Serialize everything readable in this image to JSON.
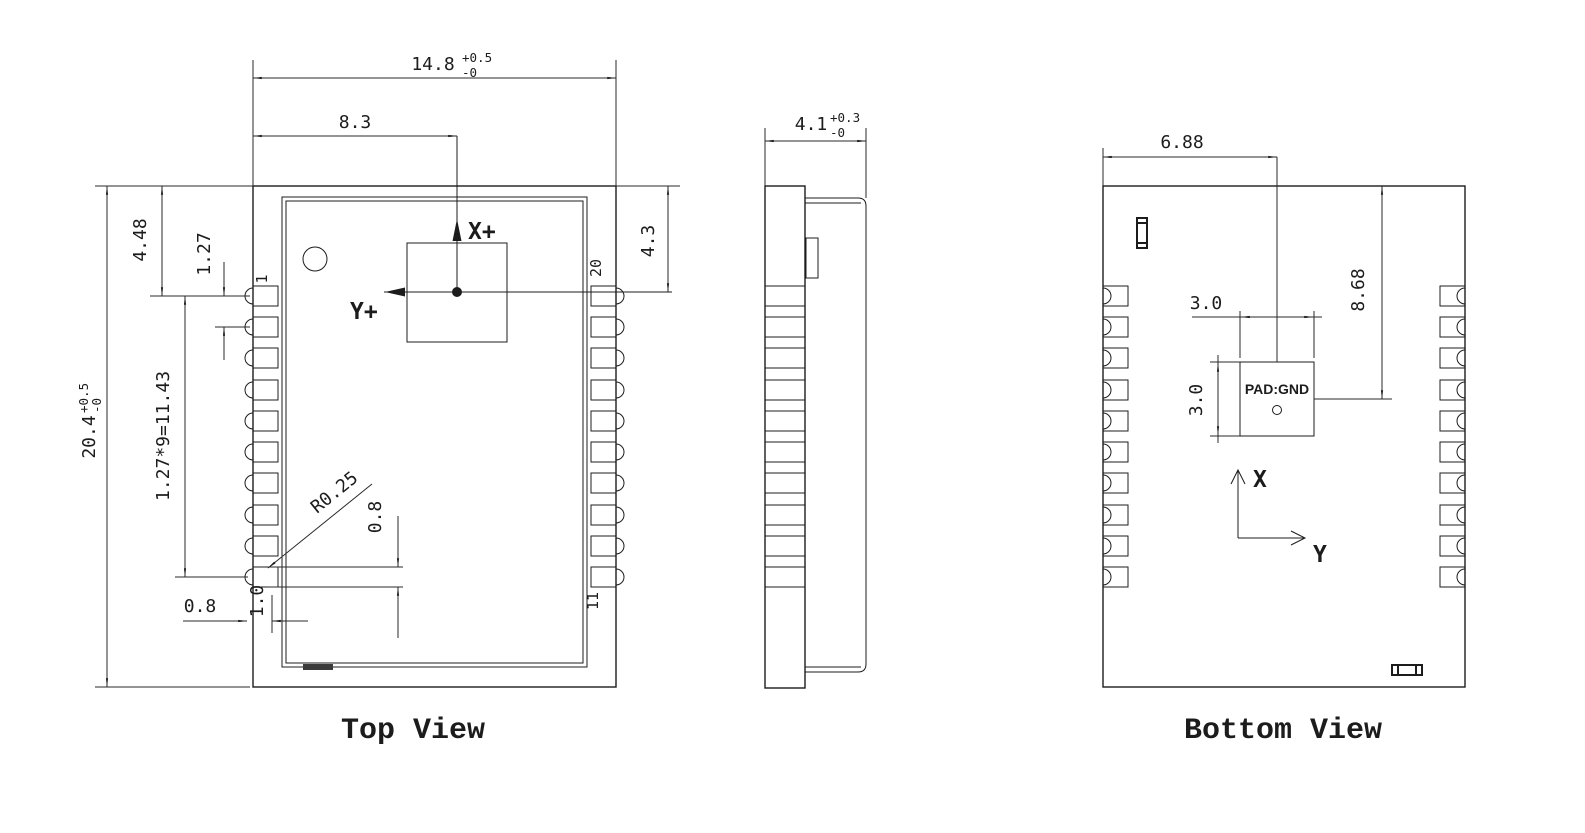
{
  "top_view": {
    "title": "Top View",
    "axis_x_label": "X+",
    "axis_y_label": "Y+",
    "pin_labels": {
      "pin1": "1",
      "pin20": "20",
      "pin11": "11"
    },
    "dimensions": {
      "overall_width": {
        "value": "14.8",
        "tol_plus": "+0.5",
        "tol_minus": "-0"
      },
      "overall_height": {
        "value": "20.4",
        "tol_plus": "+0.5",
        "tol_minus": "-0"
      },
      "center_offset_x": "8.3",
      "center_offset_y": "4.3",
      "pin1_from_top": "4.48",
      "pin_pitch": "1.27",
      "pitch_equation": "1.27*9=11.43",
      "pad_radius": "R0.25",
      "pad_width": "0.8",
      "pad_length": "1.0",
      "edge_clearance": "0.8"
    }
  },
  "side_view": {
    "dimensions": {
      "thickness": {
        "value": "4.1",
        "tol_plus": "+0.3",
        "tol_minus": "-0"
      }
    }
  },
  "bottom_view": {
    "title": "Bottom View",
    "axis_x_label": "X",
    "axis_y_label": "Y",
    "gnd_pad_label": "PAD:GND",
    "dimensions": {
      "pad_center_from_left": "6.88",
      "pad_center_from_top": "8.68",
      "pad_width": "3.0",
      "pad_height": "3.0"
    }
  }
}
